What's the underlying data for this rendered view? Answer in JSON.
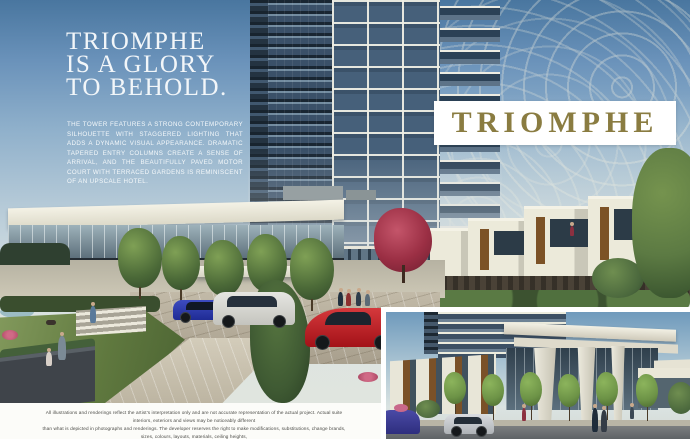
{
  "headline": {
    "line1": "TRIOMPHE",
    "line2": "IS A GLORY",
    "line3": "TO BEHOLD."
  },
  "body_copy": {
    "text": "THE TOWER FEATURES A STRONG CONTEMPORARY SILHOUETTE WITH STAGGERED LIGHTING THAT ADDS A DYNAMIC VISUAL APPEARANCE. DRAMATIC TAPERED ENTRY COLUMNS CREATE A SENSE OF ARRIVAL, AND THE BEAUTIFULLY PAVED MOTOR COURT WITH TERRACED GARDENS IS REMINISCENT OF AN UPSCALE HOTEL."
  },
  "wordmark": {
    "text": "TRIOMPHE",
    "color": "#8a7c41"
  },
  "disclaimer": {
    "line1": "All illustrations and renderings reflect the artist's interpretation only and are not accurate representation of the actual project. Actual suite interiors, exteriors and views may be noticeably different",
    "line2": "than what is depicted in photographs and renderings. The developer reserves the right to make modifications, substitutions, change brands, sizes, colours, layouts, materials, ceiling heights,",
    "line3": "features, finishes and other specifications without prior notification. Such details are governed by the applicable offer to purchase and agreement for sale and disclosure statement."
  },
  "colors": {
    "wordmark_gold": "#8a7c41",
    "band_background": "#ffffff",
    "headline_white": "#f2f6f9",
    "sky_top": "#49769f"
  }
}
